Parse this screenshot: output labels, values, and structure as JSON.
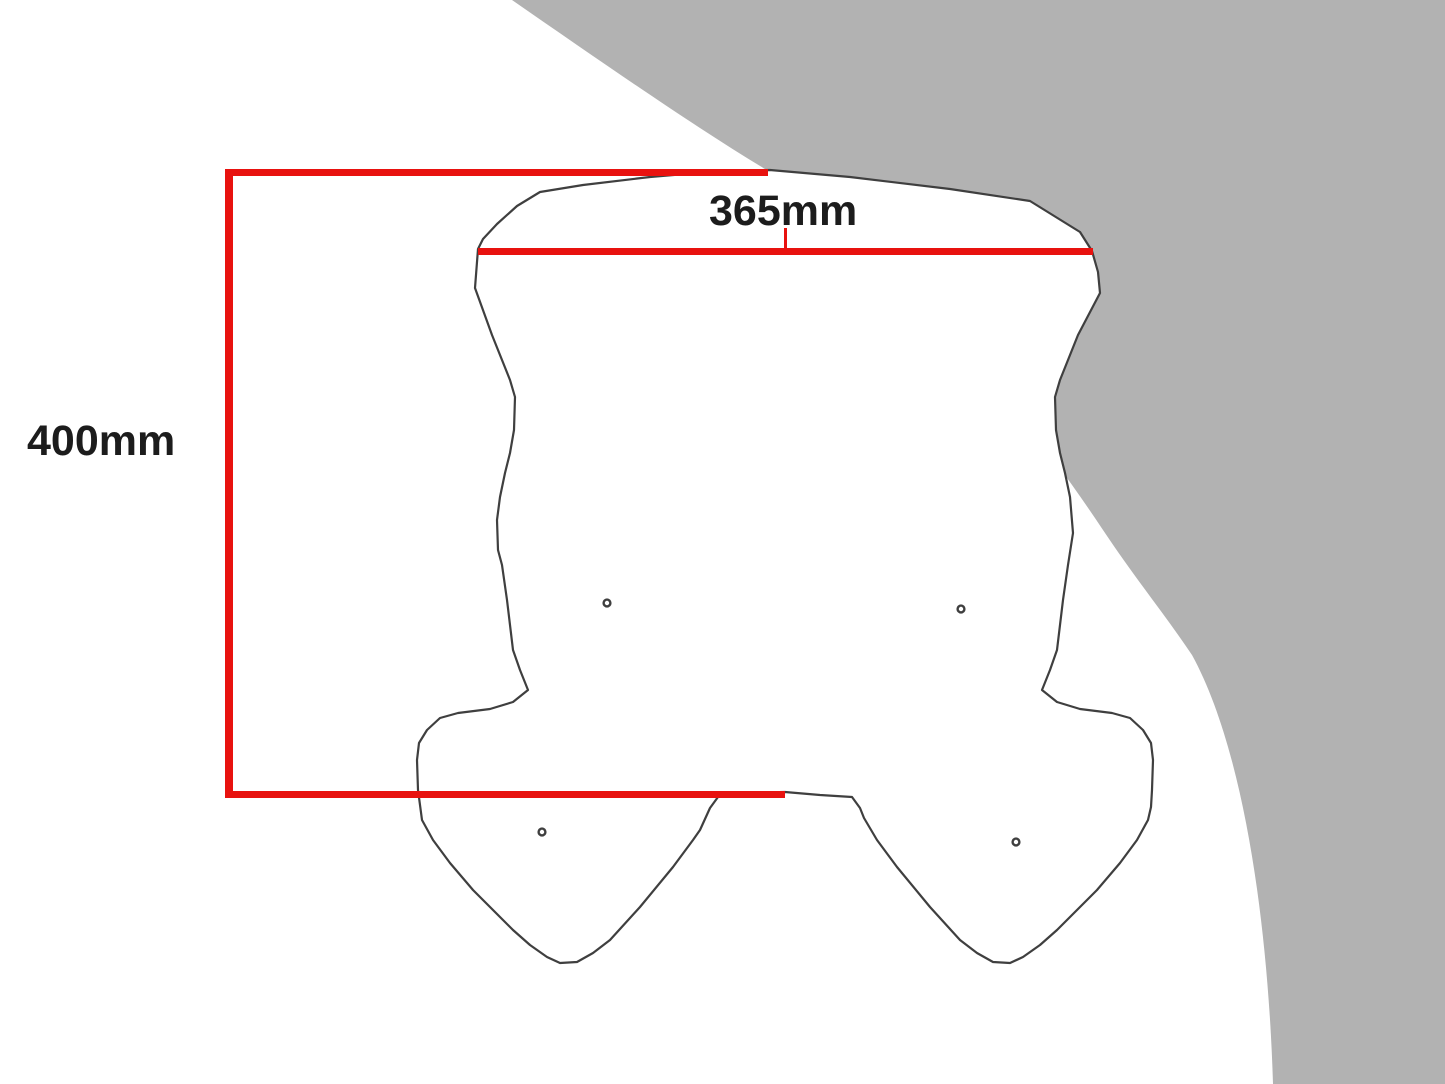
{
  "diagram": {
    "width_label": "365mm",
    "height_label": "400mm"
  },
  "colors": {
    "dimension_red": "#e8120f",
    "background_gray": "#b2b2b2",
    "outline_dark": "#3f3f3f",
    "label_text": "#1c1c1c",
    "page_background": "#ffffff"
  },
  "shapes": {
    "background_arc": "gray-quarter-disc-top-right",
    "windscreen": "motorcycle-windscreen-outline-with-4-mounting-holes"
  }
}
